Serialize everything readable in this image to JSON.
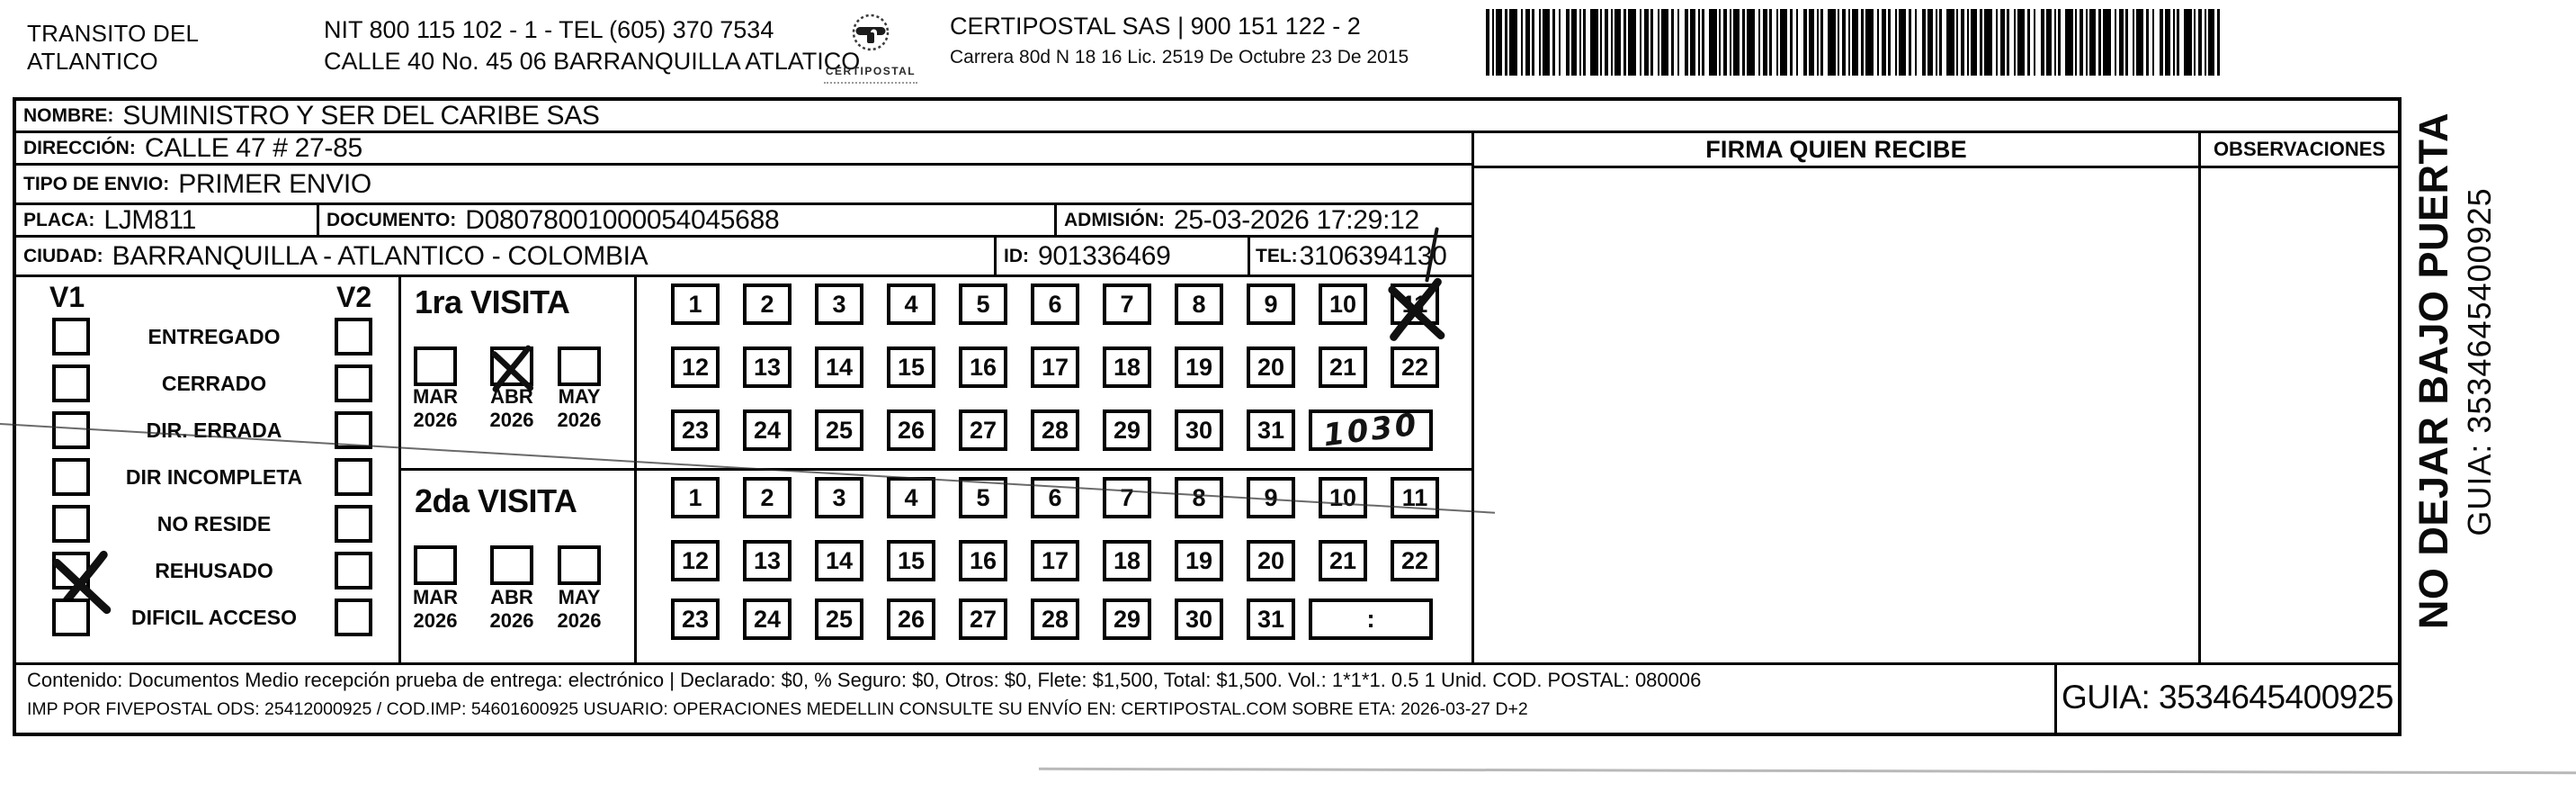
{
  "header": {
    "sender_line1": "TRANSITO DEL",
    "sender_line2": "ATLANTICO",
    "nit_line": "NIT 800 115 102 - 1 - TEL (605) 370 7534",
    "address_line": "CALLE 40 No. 45 06 BARRANQUILLA ATLATICO",
    "logo_text": "CERTIPOSTAL",
    "company_line": "CERTIPOSTAL SAS | 900 151 122 - 2",
    "company_address": "Carrera 80d N 18 16  Lic. 2519 De Octubre 23 De 2015"
  },
  "recipient": {
    "nombre_label": "NOMBRE:",
    "nombre": "SUMINISTRO Y SER DEL CARIBE SAS",
    "direccion_label": "DIRECCIÓN:",
    "direccion": "CALLE 47 # 27-85",
    "tipo_label": "TIPO DE ENVIO:",
    "tipo": "PRIMER ENVIO",
    "placa_label": "PLACA:",
    "placa": "LJM811",
    "documento_label": "DOCUMENTO:",
    "documento": "D08078001000054045688",
    "admision_label": "ADMISIÓN:",
    "admision": "25-03-2026 17:29:12",
    "ciudad_label": "CIUDAD:",
    "ciudad": "BARRANQUILLA - ATLANTICO - COLOMBIA",
    "id_label": "ID:",
    "id": "901336469",
    "tel_label": "TEL:",
    "tel": "3106394130"
  },
  "status_checklist": {
    "v1_label": "V1",
    "v2_label": "V2",
    "items": [
      {
        "label": "ENTREGADO",
        "v1_checked": false,
        "v2_checked": false
      },
      {
        "label": "CERRADO",
        "v1_checked": false,
        "v2_checked": false
      },
      {
        "label": "DIR. ERRADA",
        "v1_checked": false,
        "v2_checked": false
      },
      {
        "label": "DIR INCOMPLETA",
        "v1_checked": false,
        "v2_checked": false
      },
      {
        "label": "NO RESIDE",
        "v1_checked": false,
        "v2_checked": false
      },
      {
        "label": "REHUSADO",
        "v1_checked": true,
        "v2_checked": false,
        "x_style": "sprawl"
      },
      {
        "label": "DIFICIL ACCESO",
        "v1_checked": false,
        "v2_checked": false
      }
    ]
  },
  "calendar": {
    "day_rows": [
      [
        1,
        2,
        3,
        4,
        5,
        6,
        7,
        8,
        9,
        10,
        11
      ],
      [
        12,
        13,
        14,
        15,
        16,
        17,
        18,
        19,
        20,
        21,
        22
      ],
      [
        23,
        24,
        25,
        26,
        27,
        28,
        29,
        30,
        31
      ]
    ]
  },
  "visits": {
    "first": {
      "title": "1ra VISITA",
      "months": [
        {
          "name": "MAR",
          "year": "2026",
          "checked": false
        },
        {
          "name": "ABR",
          "year": "2026",
          "checked": true
        },
        {
          "name": "MAY",
          "year": "2026",
          "checked": false
        }
      ],
      "marked_day": 11,
      "time_value": "1030",
      "time_style": "handwritten"
    },
    "second": {
      "title": "2da VISITA",
      "months": [
        {
          "name": "MAR",
          "year": "2026",
          "checked": false
        },
        {
          "name": "ABR",
          "year": "2026",
          "checked": false
        },
        {
          "name": "MAY",
          "year": "2026",
          "checked": false
        }
      ],
      "marked_day": null,
      "time_value": ":",
      "time_style": "printed"
    }
  },
  "signature": {
    "firma_label": "FIRMA QUIEN RECIBE",
    "observaciones_label": "OBSERVACIONES"
  },
  "side_note": {
    "warning": "NO DEJAR BAJO PUERTA",
    "guia": "GUIA: 3534645400925"
  },
  "footer": {
    "content_line": "Contenido: Documentos Medio recepción prueba de entrega: electrónico | Declarado: $0, % Seguro: $0, Otros: $0, Flete: $1,500, Total: $1,500. Vol.: 1*1*1. 0.5  1 Unid. COD. POSTAL: 080006",
    "imp_line": "IMP POR FIVEPOSTAL ODS: 25412000925 / COD.IMP: 54601600925 USUARIO: OPERACIONES MEDELLIN CONSULTE SU ENVÍO EN: CERTIPOSTAL.COM SOBRE ETA: 2026-03-27 D+2",
    "guia": "GUIA: 3534645400925"
  }
}
